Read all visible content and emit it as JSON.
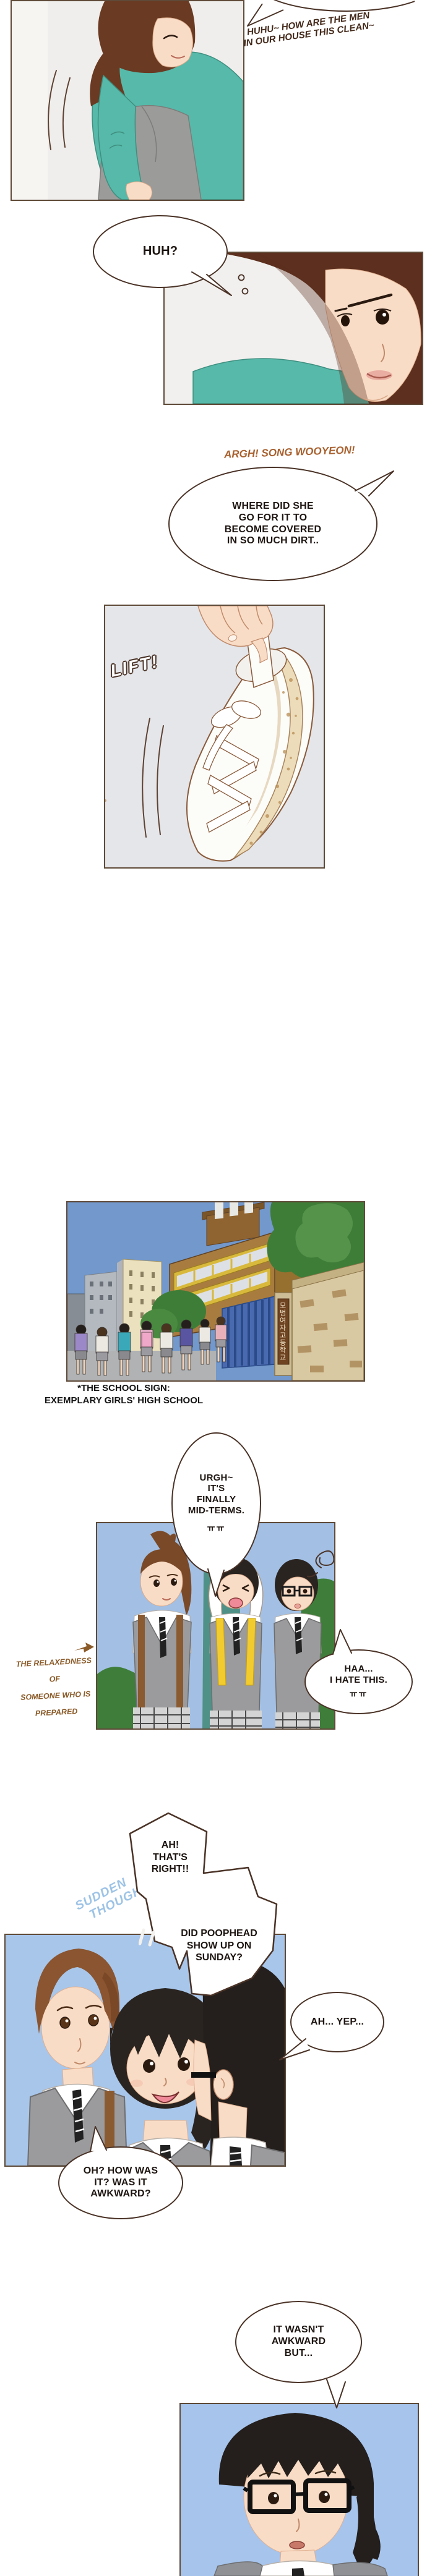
{
  "sfx": {
    "top_lines": [
      "HUHU~ HOW ARE THE MEN",
      "IN OUR HOUSE THIS CLEAN~"
    ],
    "argh": "ARGH! SONG WOOYEON!",
    "lift": "LIFT!",
    "sudden_lines": [
      "SUDDEN",
      "THOUGHT !"
    ]
  },
  "bubbles": {
    "huh": [
      "HUH?"
    ],
    "where": [
      "WHERE DID SHE",
      "GO FOR IT TO",
      "BECOME COVERED",
      "IN SO MUCH DIRT.."
    ],
    "urgh": [
      "URGH~",
      "IT'S",
      "FINALLY",
      "MID-TERMS."
    ],
    "urgh_cry": "ㅠㅠ",
    "haa": [
      "HAA...",
      "I HATE THIS."
    ],
    "haa_cry": "ㅠㅠ",
    "thats_right": [
      "AH!",
      "THAT'S",
      "RIGHT!!"
    ],
    "poophead": [
      "DID POOPHEAD",
      "SHOW UP ON",
      "SUNDAY?"
    ],
    "yep": [
      "AH... YEP..."
    ],
    "how_was_it": [
      "OH? HOW WAS",
      "IT? WAS IT",
      "AWKWARD?"
    ],
    "wasnt": [
      "IT WASN'T",
      "AWKWARD",
      "BUT..."
    ]
  },
  "captions": {
    "school_sign_note": [
      "*THE SCHOOL SIGN:",
      "EXEMPLARY GIRLS' HIGH SCHOOL"
    ],
    "relaxedness": [
      "THE RELAXEDNESS OF",
      "SOMEONE WHO IS",
      "PREPARED"
    ],
    "school_gate_sign_korean": "모범여자고등학교"
  },
  "colors": {
    "outline": "#4a3226",
    "panel_border": "#5f4a38",
    "teal_shirt": "#56b9a9",
    "sky_blue": "#7298cc",
    "pale_blue": "#a3c0e4",
    "uniform_gray": "#9b9b9d",
    "accent_yellow": "#f2cc2e",
    "sfx_orange_brown": "#a8602e",
    "caption_gold_brown": "#8a5a28",
    "sudden_thought_blue": "#9dc3e6"
  }
}
